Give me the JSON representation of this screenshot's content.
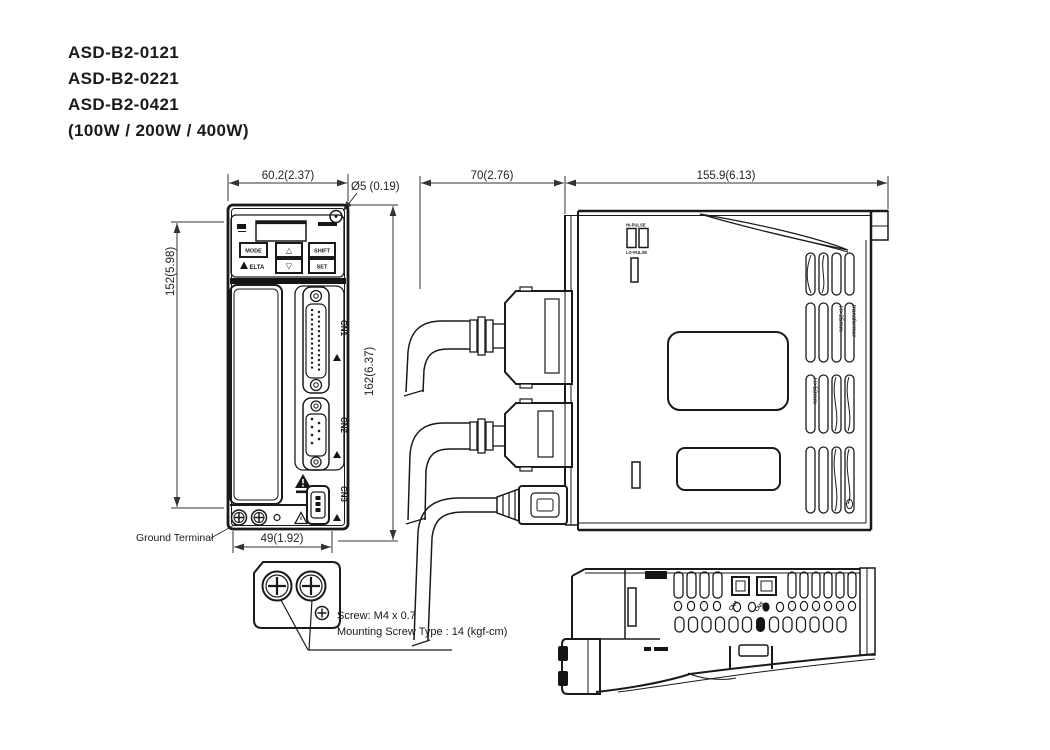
{
  "colors": {
    "accent": "#c0282d",
    "line": "#1a1a1a"
  },
  "title": {
    "model1": "ASD-B2-0121",
    "model2": "ASD-B2-0221",
    "model3": "ASD-B2-0421",
    "power": "(100W / 200W / 400W)"
  },
  "front_view": {
    "dim_width": "60.2(2.37)",
    "dim_hole": "Ø5 (0.19)",
    "dim_mount_height": "152(5.98)",
    "dim_total_height": "162(6.37)",
    "dim_base_width": "49(1.92)",
    "ground_terminal_label": "Ground Terminal",
    "keypad": {
      "mode": "MODE",
      "shift": "SHIFT",
      "set": "SET",
      "up": "△",
      "down": "▽",
      "brand": "ELTA"
    },
    "connector_cn1": "CN1",
    "connector_cn2": "CN2",
    "connector_cn3": "CN3"
  },
  "side_view": {
    "dim_depth": "70(2.76)",
    "dim_width": "155.9(6.13)",
    "switch_hi": "HI-PULSE",
    "switch_lo": "LO-PULSE",
    "vent_note_1": "H>25mm",
    "vent_note_2": "transformer",
    "vent_note_3": "H>50mm"
  },
  "bottom_view": {
    "connector_cn4": "CN4",
    "connector_cn5": "CN5"
  },
  "mounting_note": {
    "line1": "Screw: M4 x 0.7",
    "line2": "Mounting Screw Type : 14 (kgf-cm)"
  }
}
